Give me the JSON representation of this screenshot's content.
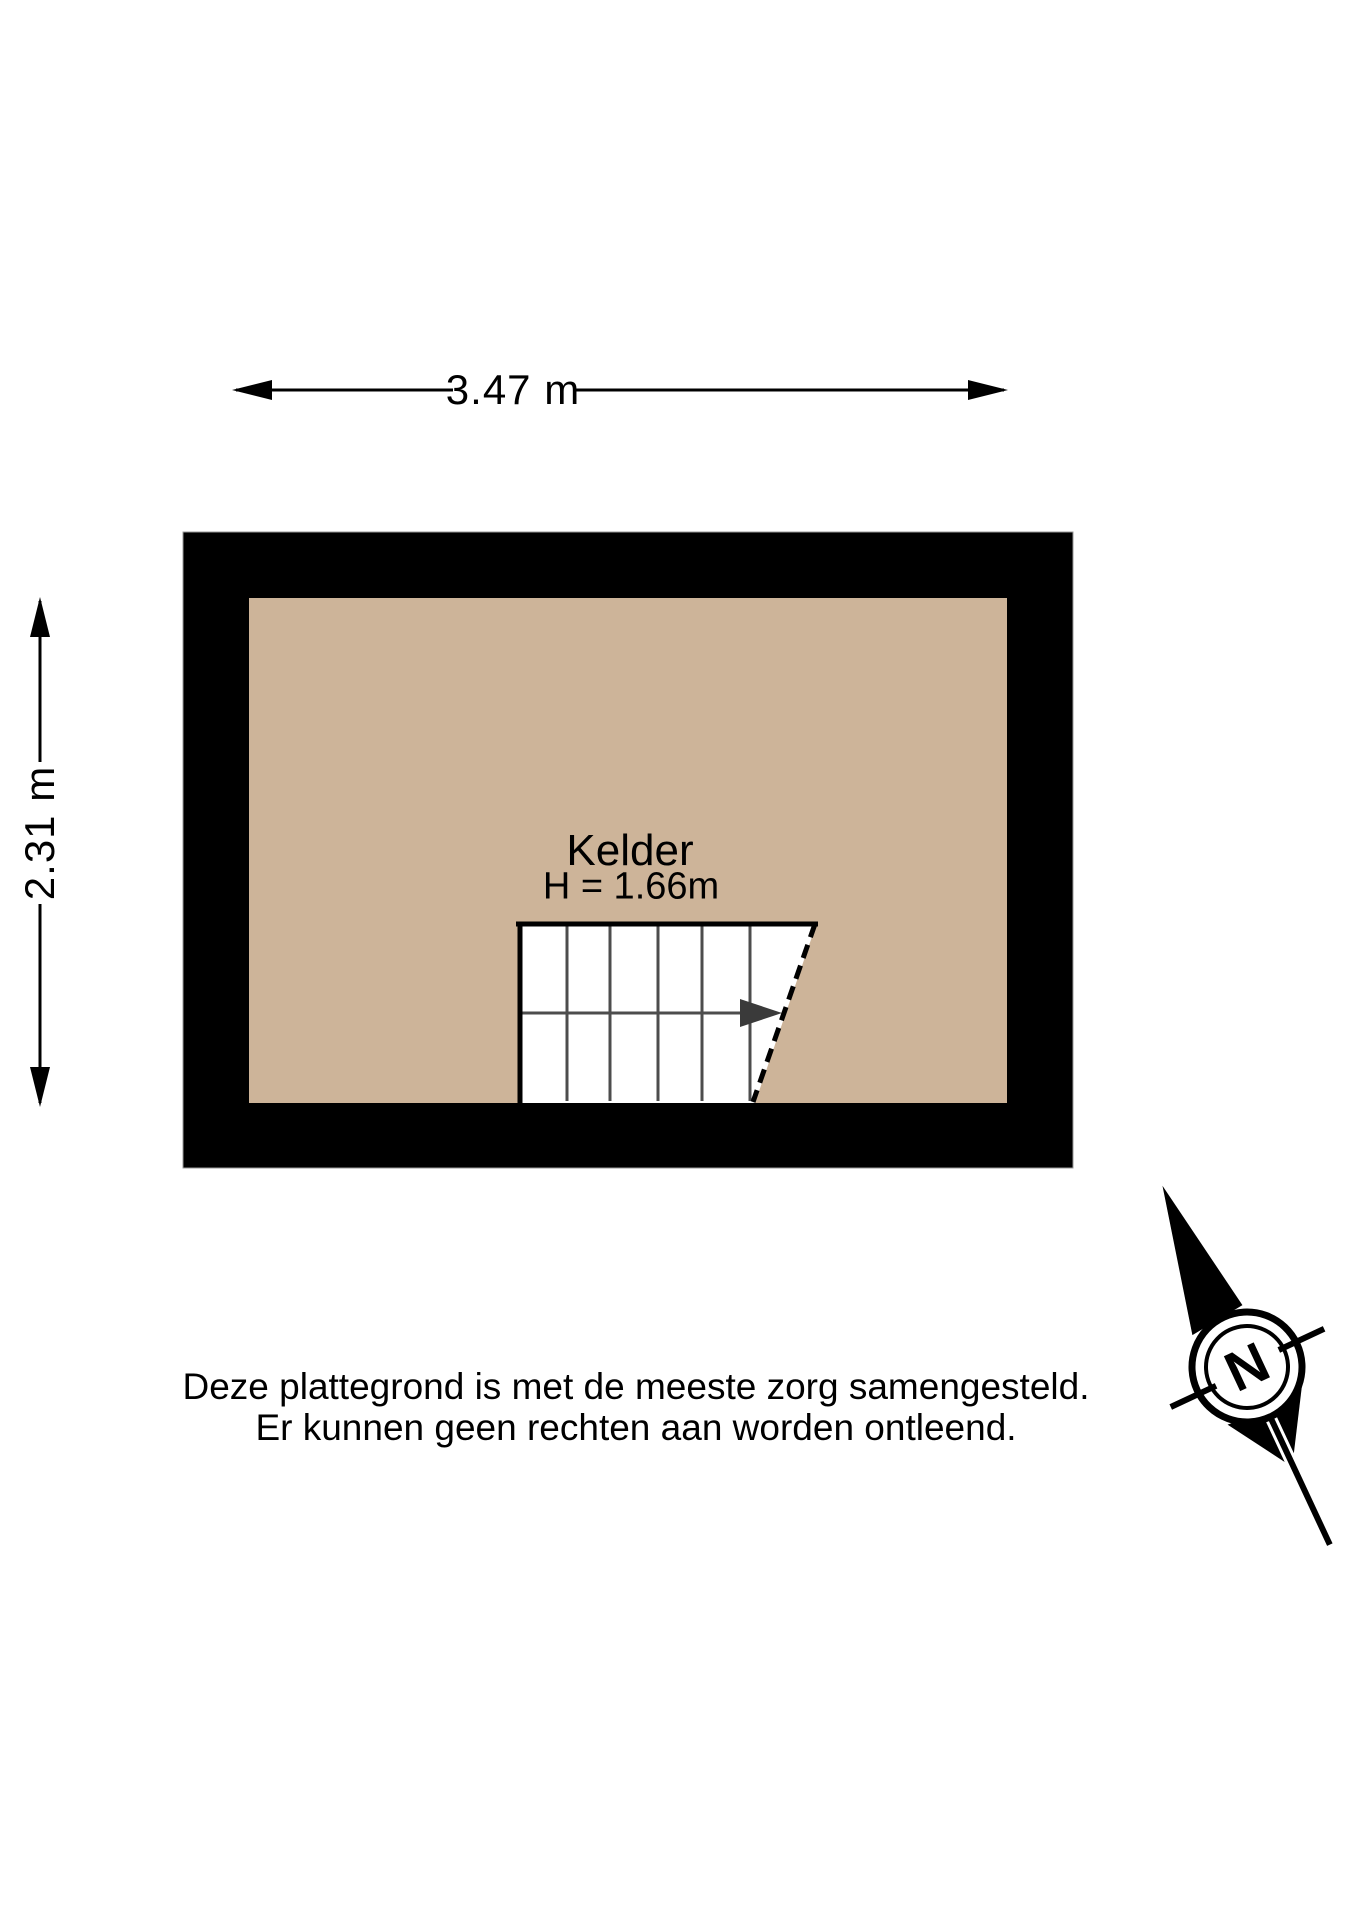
{
  "dimensions": {
    "width_label": "3.47 m",
    "height_label": "2.31 m"
  },
  "room": {
    "name": "Kelder",
    "height_label": "H = 1.66m"
  },
  "disclaimer": {
    "line1": "Deze plattegrond is met de meeste zorg samengesteld.",
    "line2": "Er kunnen geen rechten aan worden ontleend."
  },
  "compass": {
    "north_label": "N"
  },
  "colors": {
    "wall": "#000000",
    "floor": "#CDB499",
    "stair_fill": "#FFFFFF",
    "stair_step_line": "#4D4D4D",
    "walkline_arrow": "#3A3A3A",
    "dimension_line": "#000000"
  }
}
